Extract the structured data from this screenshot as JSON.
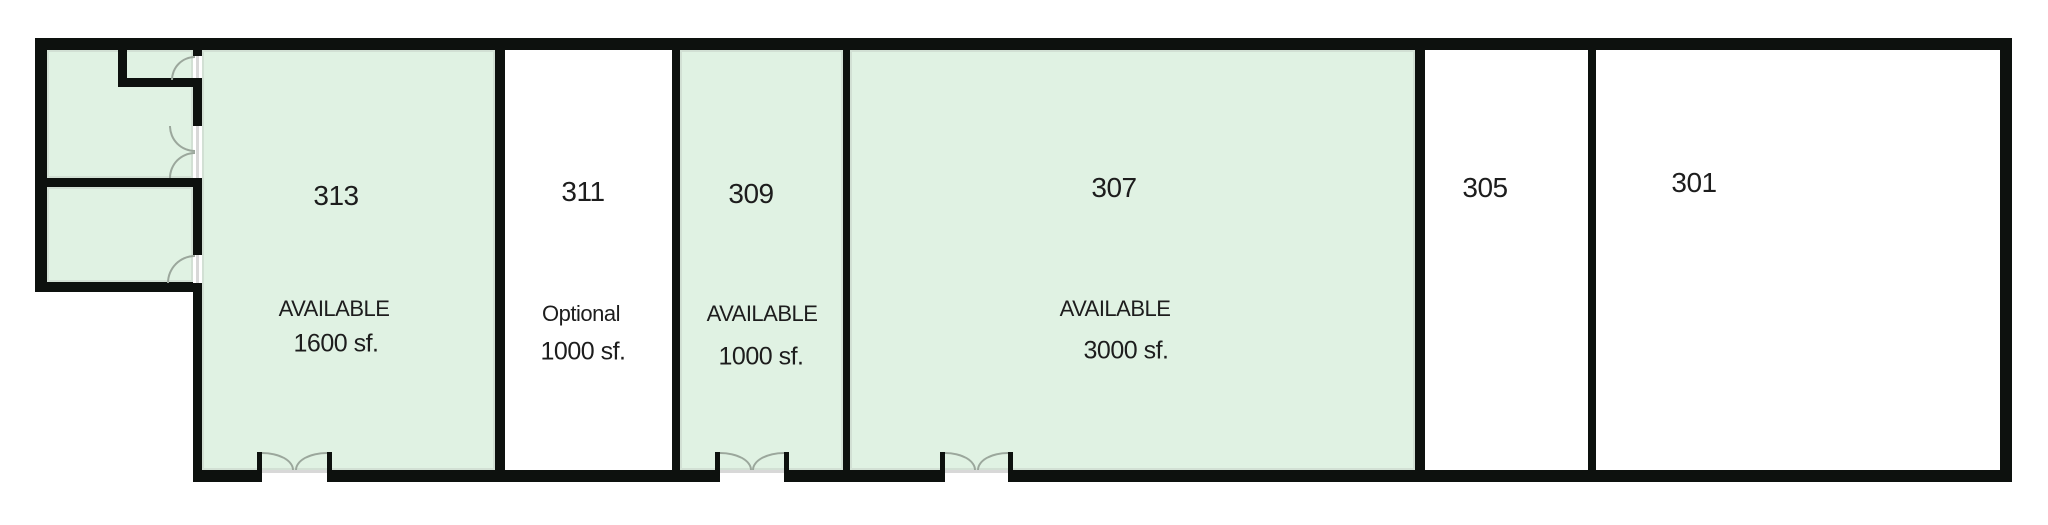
{
  "plan": {
    "type": "floor-plan",
    "description": "Commercial suite floor plan strip with six units; highlighted units are available",
    "rooms": [
      {
        "number": "313",
        "status_label": "AVAILABLE",
        "size_label": "1600 sf.",
        "highlighted": true
      },
      {
        "number": "311",
        "status_label": "Optional",
        "size_label": "1000 sf.",
        "highlighted": false
      },
      {
        "number": "309",
        "status_label": "AVAILABLE",
        "size_label": "1000 sf.",
        "highlighted": true
      },
      {
        "number": "307",
        "status_label": "AVAILABLE",
        "size_label": "3000 sf.",
        "highlighted": true
      },
      {
        "number": "305",
        "highlighted": false
      },
      {
        "number": "301",
        "highlighted": false
      }
    ],
    "colors": {
      "available_fill": "#e0f2e3",
      "wall": "#0d110e",
      "door_arc": "#9ba79c",
      "threshold": "#d8d8d8",
      "text": "#1d1d1d",
      "background": "#ffffff"
    }
  }
}
